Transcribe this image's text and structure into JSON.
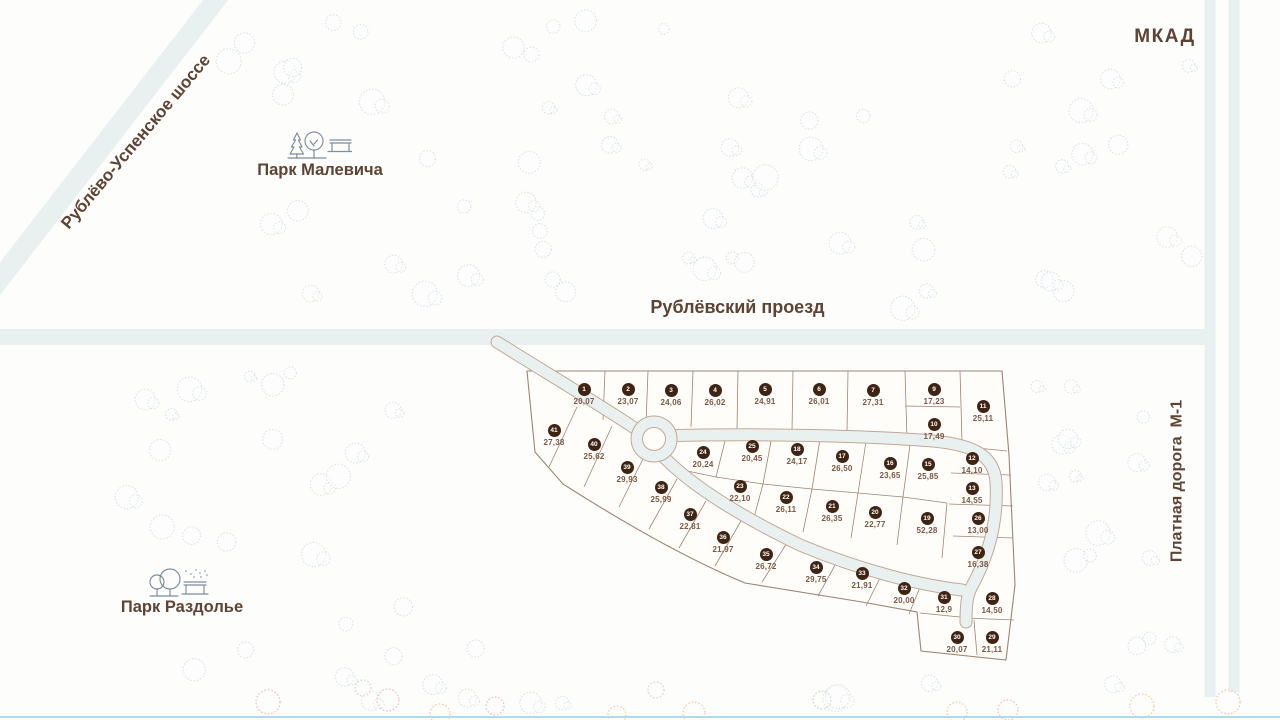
{
  "labels": {
    "mkad": "МКАД",
    "rublevo_uspenskoe": "Рублёво-Успенское шоссе",
    "rublevsky_proezd": "Рублёвский проезд",
    "platnaya_doroga": "Платная дорога  М-1",
    "park_malevicha": "Парк Малевича",
    "park_razdolye": "Парк Раздолье"
  },
  "colors": {
    "bg": "#fdfdfc",
    "dev_fill": "#fffdfa",
    "label_brown": "#5e4334",
    "plot_line": "#a08372",
    "road_fill": "#e9f0f0",
    "road_edge": "#c2a896",
    "badge_fill": "#3f2413",
    "badge_text": "#ffffff",
    "area_text": "#7a5743",
    "tree_blue": "#cddce3",
    "tree_green": "#d3dfd5",
    "tree_pink": "#efb3bc",
    "tree_orange": "#f3c39b",
    "tree_olive": "#c8d6c3",
    "bottom_line": "#b3d8ec",
    "icon_stroke": "#667a8d"
  },
  "plots": [
    {
      "num": "1",
      "area": "20,07",
      "x": 584,
      "y": 389
    },
    {
      "num": "2",
      "area": "23,07",
      "x": 628,
      "y": 389
    },
    {
      "num": "3",
      "area": "24,06",
      "x": 671,
      "y": 390
    },
    {
      "num": "4",
      "area": "26,02",
      "x": 715,
      "y": 390
    },
    {
      "num": "5",
      "area": "24,91",
      "x": 765,
      "y": 389
    },
    {
      "num": "6",
      "area": "26,01",
      "x": 819,
      "y": 389
    },
    {
      "num": "7",
      "area": "27,31",
      "x": 873,
      "y": 390
    },
    {
      "num": "9",
      "area": "17,23",
      "x": 934,
      "y": 389
    },
    {
      "num": "10",
      "area": "17,49",
      "x": 934,
      "y": 424
    },
    {
      "num": "11",
      "area": "25,11",
      "x": 983,
      "y": 406
    },
    {
      "num": "12",
      "area": "14,10",
      "x": 972,
      "y": 458
    },
    {
      "num": "13",
      "area": "14,55",
      "x": 972,
      "y": 488
    },
    {
      "num": "15",
      "area": "25,85",
      "x": 928,
      "y": 464
    },
    {
      "num": "16",
      "area": "23,65",
      "x": 890,
      "y": 463
    },
    {
      "num": "17",
      "area": "26,50",
      "x": 842,
      "y": 456
    },
    {
      "num": "18",
      "area": "24,17",
      "x": 797,
      "y": 449
    },
    {
      "num": "19",
      "area": "52,28",
      "x": 927,
      "y": 518
    },
    {
      "num": "20",
      "area": "22,77",
      "x": 875,
      "y": 512
    },
    {
      "num": "21",
      "area": "26,35",
      "x": 832,
      "y": 506
    },
    {
      "num": "22",
      "area": "26,11",
      "x": 786,
      "y": 497
    },
    {
      "num": "23",
      "area": "22,10",
      "x": 740,
      "y": 486
    },
    {
      "num": "24",
      "area": "20,24",
      "x": 703,
      "y": 452
    },
    {
      "num": "25",
      "area": "20,45",
      "x": 752,
      "y": 446
    },
    {
      "num": "26",
      "area": "13,00",
      "x": 978,
      "y": 518
    },
    {
      "num": "27",
      "area": "16,38",
      "x": 978,
      "y": 552
    },
    {
      "num": "28",
      "area": "14,50",
      "x": 992,
      "y": 598
    },
    {
      "num": "29",
      "area": "21,11",
      "x": 992,
      "y": 637
    },
    {
      "num": "30",
      "area": "20,07",
      "x": 957,
      "y": 637
    },
    {
      "num": "31",
      "area": "12,9",
      "x": 944,
      "y": 597
    },
    {
      "num": "32",
      "area": "20,00",
      "x": 904,
      "y": 588
    },
    {
      "num": "33",
      "area": "21,91",
      "x": 862,
      "y": 573
    },
    {
      "num": "34",
      "area": "29,75",
      "x": 816,
      "y": 567
    },
    {
      "num": "35",
      "area": "26,72",
      "x": 766,
      "y": 554
    },
    {
      "num": "36",
      "area": "21,97",
      "x": 723,
      "y": 537
    },
    {
      "num": "37",
      "area": "22,81",
      "x": 690,
      "y": 514
    },
    {
      "num": "38",
      "area": "25,99",
      "x": 661,
      "y": 487
    },
    {
      "num": "39",
      "area": "29,93",
      "x": 627,
      "y": 467
    },
    {
      "num": "40",
      "area": "25,62",
      "x": 594,
      "y": 444
    },
    {
      "num": "41",
      "area": "27,38",
      "x": 554,
      "y": 430
    }
  ]
}
